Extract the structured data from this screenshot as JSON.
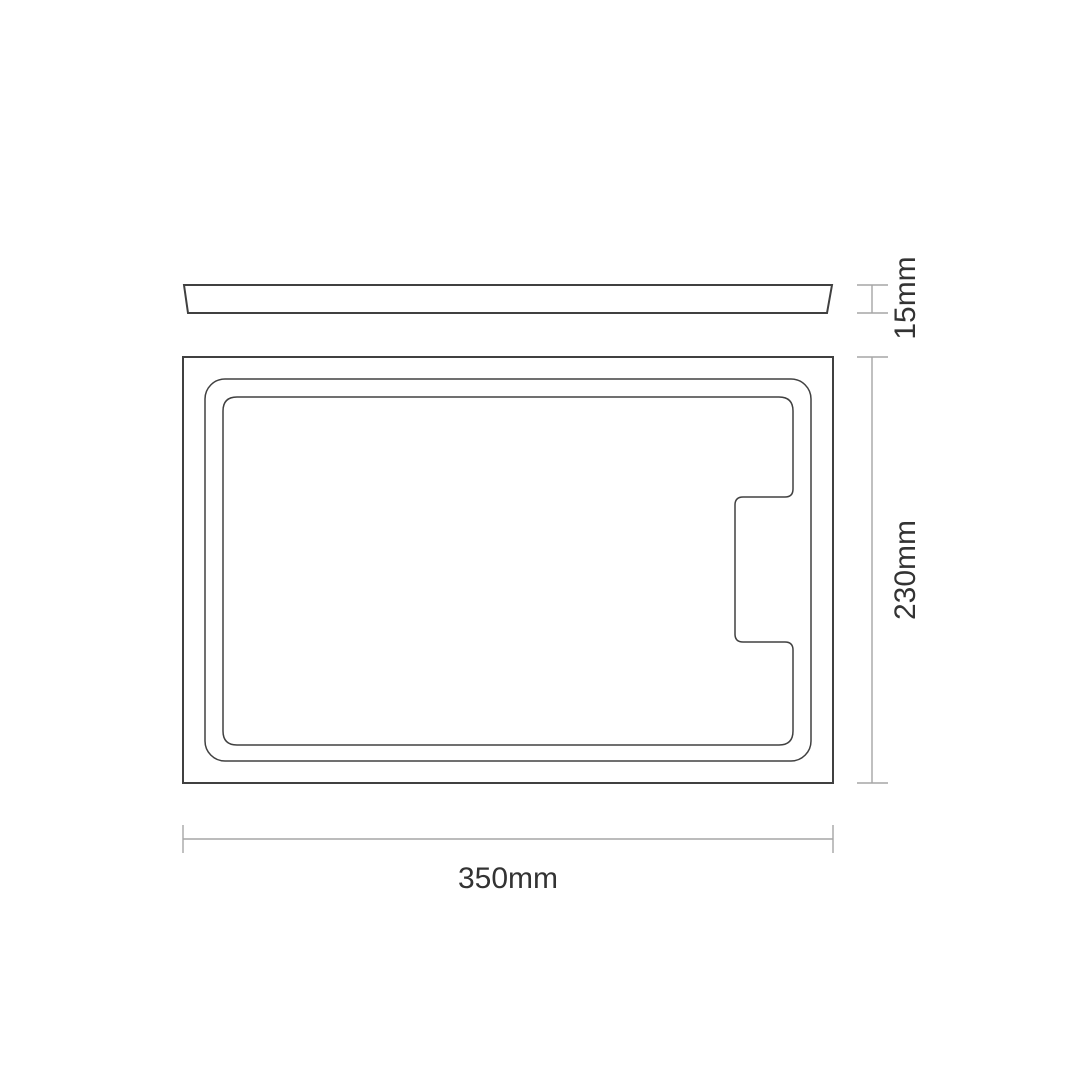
{
  "drawing": {
    "dimensions": {
      "thickness": {
        "label": "15mm",
        "value": 15,
        "unit": "mm",
        "orientation": "vertical"
      },
      "depth": {
        "label": "230mm",
        "value": 230,
        "unit": "mm",
        "orientation": "vertical"
      },
      "width": {
        "label": "350mm",
        "value": 350,
        "unit": "mm",
        "orientation": "horizontal"
      }
    },
    "colors": {
      "background": "#ffffff",
      "outline": "#404040",
      "dimension_line": "#a6a6a6",
      "label_text": "#333333"
    }
  }
}
